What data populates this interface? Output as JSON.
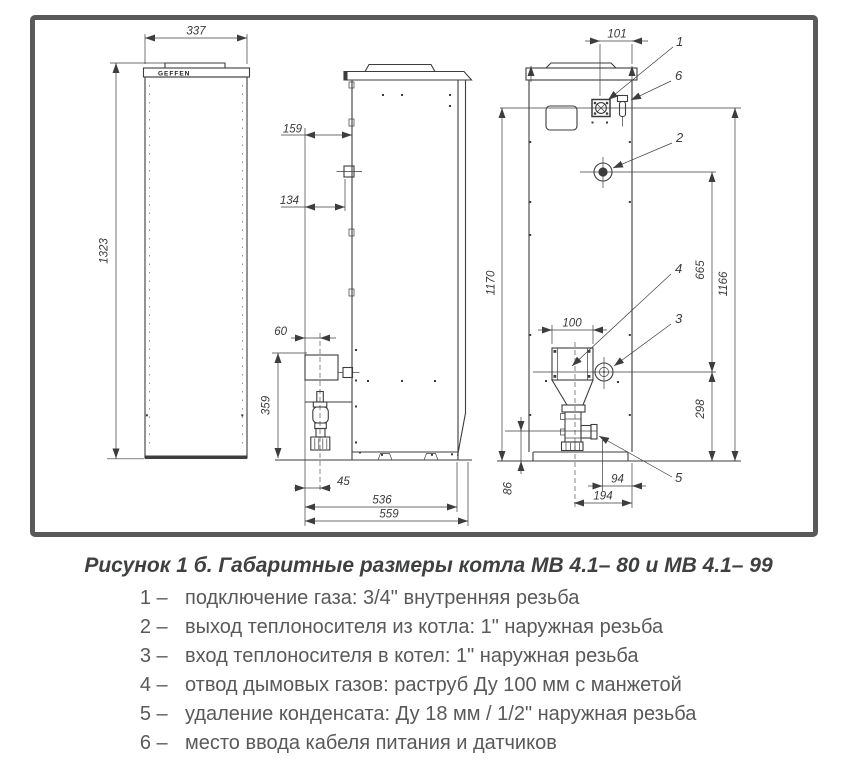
{
  "drawing": {
    "brand": "GEFFEN",
    "dims": {
      "front_width": "337",
      "front_height": "1323",
      "front_offset": "159",
      "gas_fitting_offset": "134",
      "valve_center_offset": "60",
      "valve_height": "359",
      "valve_axis_offset": "45",
      "body_depth": "536",
      "total_depth": "559",
      "gas_offset": "101",
      "flue_width": "100",
      "gas_height": "1170",
      "gland_height": "1166",
      "outlet_to_inlet": "665",
      "inlet_height": "298",
      "drain_height": "86",
      "drain_to_back": "94",
      "flue_to_back": "194"
    },
    "callouts": [
      "1",
      "2",
      "3",
      "4",
      "5",
      "6"
    ]
  },
  "figure": {
    "caption": "Рисунок 1 б. Габаритные размеры котла МВ 4.1– 80 и МВ 4.1– 99",
    "dash": "–",
    "legend": [
      {
        "num": "1",
        "text": "подключение газа: 3/4\" внутренняя резьба"
      },
      {
        "num": "2",
        "text": "выход теплоносителя из котла: 1\" наружная резьба"
      },
      {
        "num": "3",
        "text": "вход теплоносителя в котел: 1\" наружная резьба"
      },
      {
        "num": "4",
        "text": "отвод дымовых газов: раструб Ду 100 мм с манжетой"
      },
      {
        "num": "5",
        "text": "удаление конденсата: Ду 18 мм / 1/2\" наружная резьба"
      },
      {
        "num": "6",
        "text": "место ввода кабеля питания и датчиков"
      }
    ]
  },
  "colors": {
    "line": "#3d3d3d",
    "frame": "#595959",
    "text": "#58595b",
    "title": "#3f4042"
  }
}
